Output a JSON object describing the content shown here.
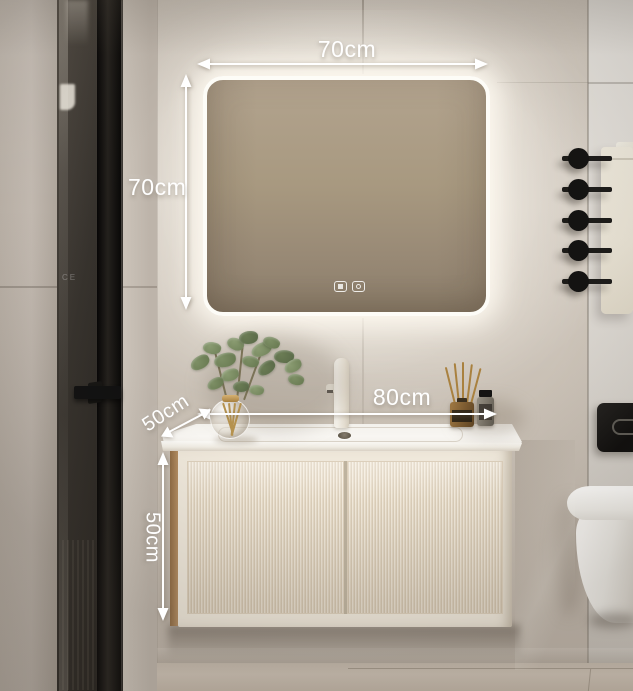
{
  "annotations": {
    "mirror_width": "70cm",
    "mirror_height": "70cm",
    "vanity_width": "80cm",
    "counter_depth": "50cm",
    "cabinet_height": "50cm"
  },
  "glass_panel": {
    "marking": "CE"
  },
  "icons": {
    "mirror_buttons": [
      "defog-icon",
      "power-icon"
    ],
    "towel_rack": "towel-bar-icon",
    "dimension_arrows": "double-headed-arrow-icon"
  },
  "palette": {
    "annotation_white": "#ffffff",
    "wall_beige": "#cfc7bd",
    "tile_wall": "#e0dcd6",
    "mirror_taupe": "#a2937f",
    "counter_white": "#f5f2ec",
    "cabinet_cream": "#eae1d2",
    "wood_trim": "#a97f52",
    "hardware_black": "#161412",
    "leaf_green": "#72845d",
    "amber_glass": "#7b5a30",
    "floor_tan": "#c6bbae"
  }
}
